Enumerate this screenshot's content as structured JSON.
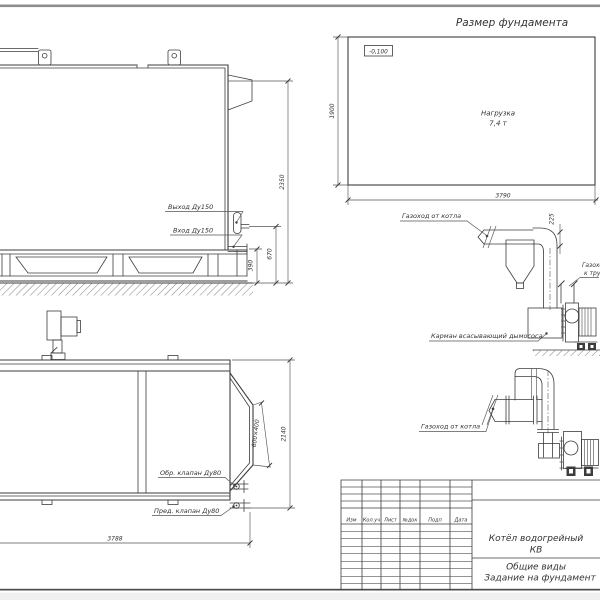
{
  "drawing": {
    "background": "#ffffff",
    "line_color": "#3c3c3c",
    "sheet_edge_color": "#8e8e8e"
  },
  "foundation_plan": {
    "title": "Размер фундамента",
    "elevation_mark": "-0,100",
    "load_line1": "Нагрузка",
    "load_line2": "7,4 т",
    "height_dim": "1900",
    "width_dim": "3790"
  },
  "boiler_side_view": {
    "outlet_label": "Выход Ду150",
    "inlet_label": "Вход Ду150",
    "total_height_dim": "2350",
    "outlet_height_dim": "670",
    "inlet_height_dim": "390"
  },
  "boiler_plan_view": {
    "check_valve_label": "Обр. клапан Ду80",
    "safety_valve_label": "Пред. клапан Ду80",
    "length_dim": "3788",
    "width_dim": "2140",
    "flue_opening_dim": "600×400"
  },
  "flue_elevation_view": {
    "from_boiler_label": "Газоход от котла",
    "duct_dim": "225",
    "to_chimney_line1": "Газоход",
    "to_chimney_line2": "к трубе",
    "suction_pocket_label": "Карман всасывающий дымососа"
  },
  "flue_plan_view": {
    "from_boiler_label": "Газоход от котла"
  },
  "title_block": {
    "columns": [
      "Изм",
      "Кол.уч",
      "Лист",
      "№док",
      "Подп",
      "Дата"
    ],
    "product_line1": "Котёл водогрейный",
    "product_line2": "КВ",
    "doc_line1": "Общие виды",
    "doc_line2": "Задание на фундамент"
  }
}
